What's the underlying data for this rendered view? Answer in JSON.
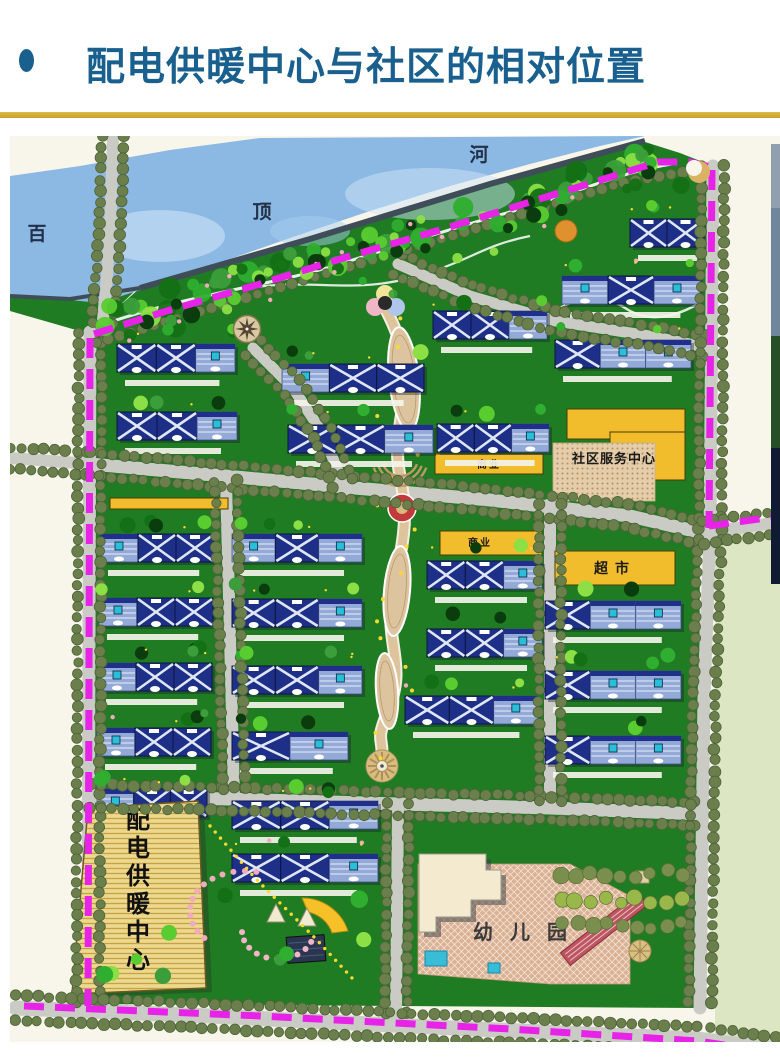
{
  "slide": {
    "title": "配电供暖中心与社区的相对位置"
  },
  "theme": {
    "title_color": "#19608f",
    "bullet_color": "#19608f",
    "accent_gold": "#c9a22c",
    "boundary_magenta": "#e623e6",
    "river_blue": "#8bb9e4",
    "grass_green": "#1f7c22",
    "road_gray": "#cbcbc6",
    "roof_navy": "#1e2f88",
    "commercial_yellow": "#f2bd2c",
    "plaza_tan": "#dcc49e"
  },
  "map": {
    "labels": {
      "river_left": "百",
      "river_mid": "顶",
      "river_right": "河",
      "commercial_upper": "商业",
      "commercial_lower": "商业",
      "supermarket": "超市",
      "community_center": "社区服务中心",
      "heating_center": "配电供暖中心",
      "kindergarten": "幼儿园"
    },
    "building_rows": [
      {
        "x": 107,
        "y": 208,
        "w": 118,
        "segs": "xxs"
      },
      {
        "x": 107,
        "y": 276,
        "w": 120,
        "segs": "xxs"
      },
      {
        "x": 272,
        "y": 228,
        "w": 142,
        "segs": "sxx"
      },
      {
        "x": 278,
        "y": 289,
        "w": 145,
        "segs": "xxs"
      },
      {
        "x": 620,
        "y": 83,
        "w": 74,
        "segs": "xx"
      },
      {
        "x": 552,
        "y": 140,
        "w": 138,
        "segs": "sxs"
      },
      {
        "x": 423,
        "y": 175,
        "w": 114,
        "segs": "xxs"
      },
      {
        "x": 545,
        "y": 204,
        "w": 136,
        "segs": "xss"
      },
      {
        "x": 427,
        "y": 288,
        "w": 112,
        "segs": "xxs"
      },
      {
        "x": 417,
        "y": 425,
        "w": 115,
        "segs": "xxs"
      },
      {
        "x": 417,
        "y": 493,
        "w": 115,
        "segs": "xxs"
      },
      {
        "x": 395,
        "y": 560,
        "w": 133,
        "segs": "xxs"
      },
      {
        "x": 222,
        "y": 398,
        "w": 130,
        "segs": "sxs"
      },
      {
        "x": 222,
        "y": 463,
        "w": 130,
        "segs": "xxs"
      },
      {
        "x": 222,
        "y": 530,
        "w": 130,
        "segs": "xxs"
      },
      {
        "x": 222,
        "y": 596,
        "w": 116,
        "segs": "xs"
      },
      {
        "x": 90,
        "y": 398,
        "w": 114,
        "segs": "sxx"
      },
      {
        "x": 89,
        "y": 462,
        "w": 114,
        "segs": "sxx"
      },
      {
        "x": 88,
        "y": 527,
        "w": 114,
        "segs": "sxx"
      },
      {
        "x": 87,
        "y": 592,
        "w": 114,
        "segs": "sxx"
      },
      {
        "x": 87,
        "y": 653,
        "w": 110,
        "segs": "sxx"
      },
      {
        "x": 222,
        "y": 665,
        "w": 146,
        "segs": "xxs"
      },
      {
        "x": 222,
        "y": 718,
        "w": 146,
        "segs": "xxs"
      },
      {
        "x": 535,
        "y": 465,
        "w": 136,
        "segs": "xss"
      },
      {
        "x": 535,
        "y": 535,
        "w": 136,
        "segs": "xss"
      },
      {
        "x": 535,
        "y": 600,
        "w": 136,
        "segs": "xss"
      }
    ],
    "yellow_strips": [
      {
        "x": 425,
        "y": 318,
        "w": 108,
        "h": 20,
        "label_key": "commercial_upper",
        "cx": 479,
        "cy": 332,
        "fs": 10,
        "ls": 2
      },
      {
        "x": 430,
        "y": 395,
        "w": 102,
        "h": 24,
        "label_key": "commercial_lower",
        "cx": 470,
        "cy": 410,
        "fs": 10,
        "ls": 2
      },
      {
        "x": 545,
        "y": 415,
        "w": 120,
        "h": 34,
        "label_key": "supermarket",
        "cx": 605,
        "cy": 437,
        "fs": 14,
        "ls": 7
      },
      {
        "x": 100,
        "y": 362,
        "w": 118,
        "h": 11
      }
    ],
    "community_center": {
      "yellow_rects": [
        [
          557,
          273,
          118,
          30
        ],
        [
          600,
          296,
          75,
          48
        ]
      ],
      "plaza": [
        543,
        307,
        102,
        58
      ],
      "label_cx": 604,
      "label_cy": 327,
      "label_fs": 13
    },
    "heating_center": {
      "poly": "78,672 188,665 196,852 62,858",
      "char_x": 128,
      "char_y0": 692,
      "char_dy": 28,
      "char_fs": 24
    },
    "kindergarten": {
      "label_x": 463,
      "label_y": 803,
      "label_fs": 20,
      "label_ls": 17
    }
  }
}
